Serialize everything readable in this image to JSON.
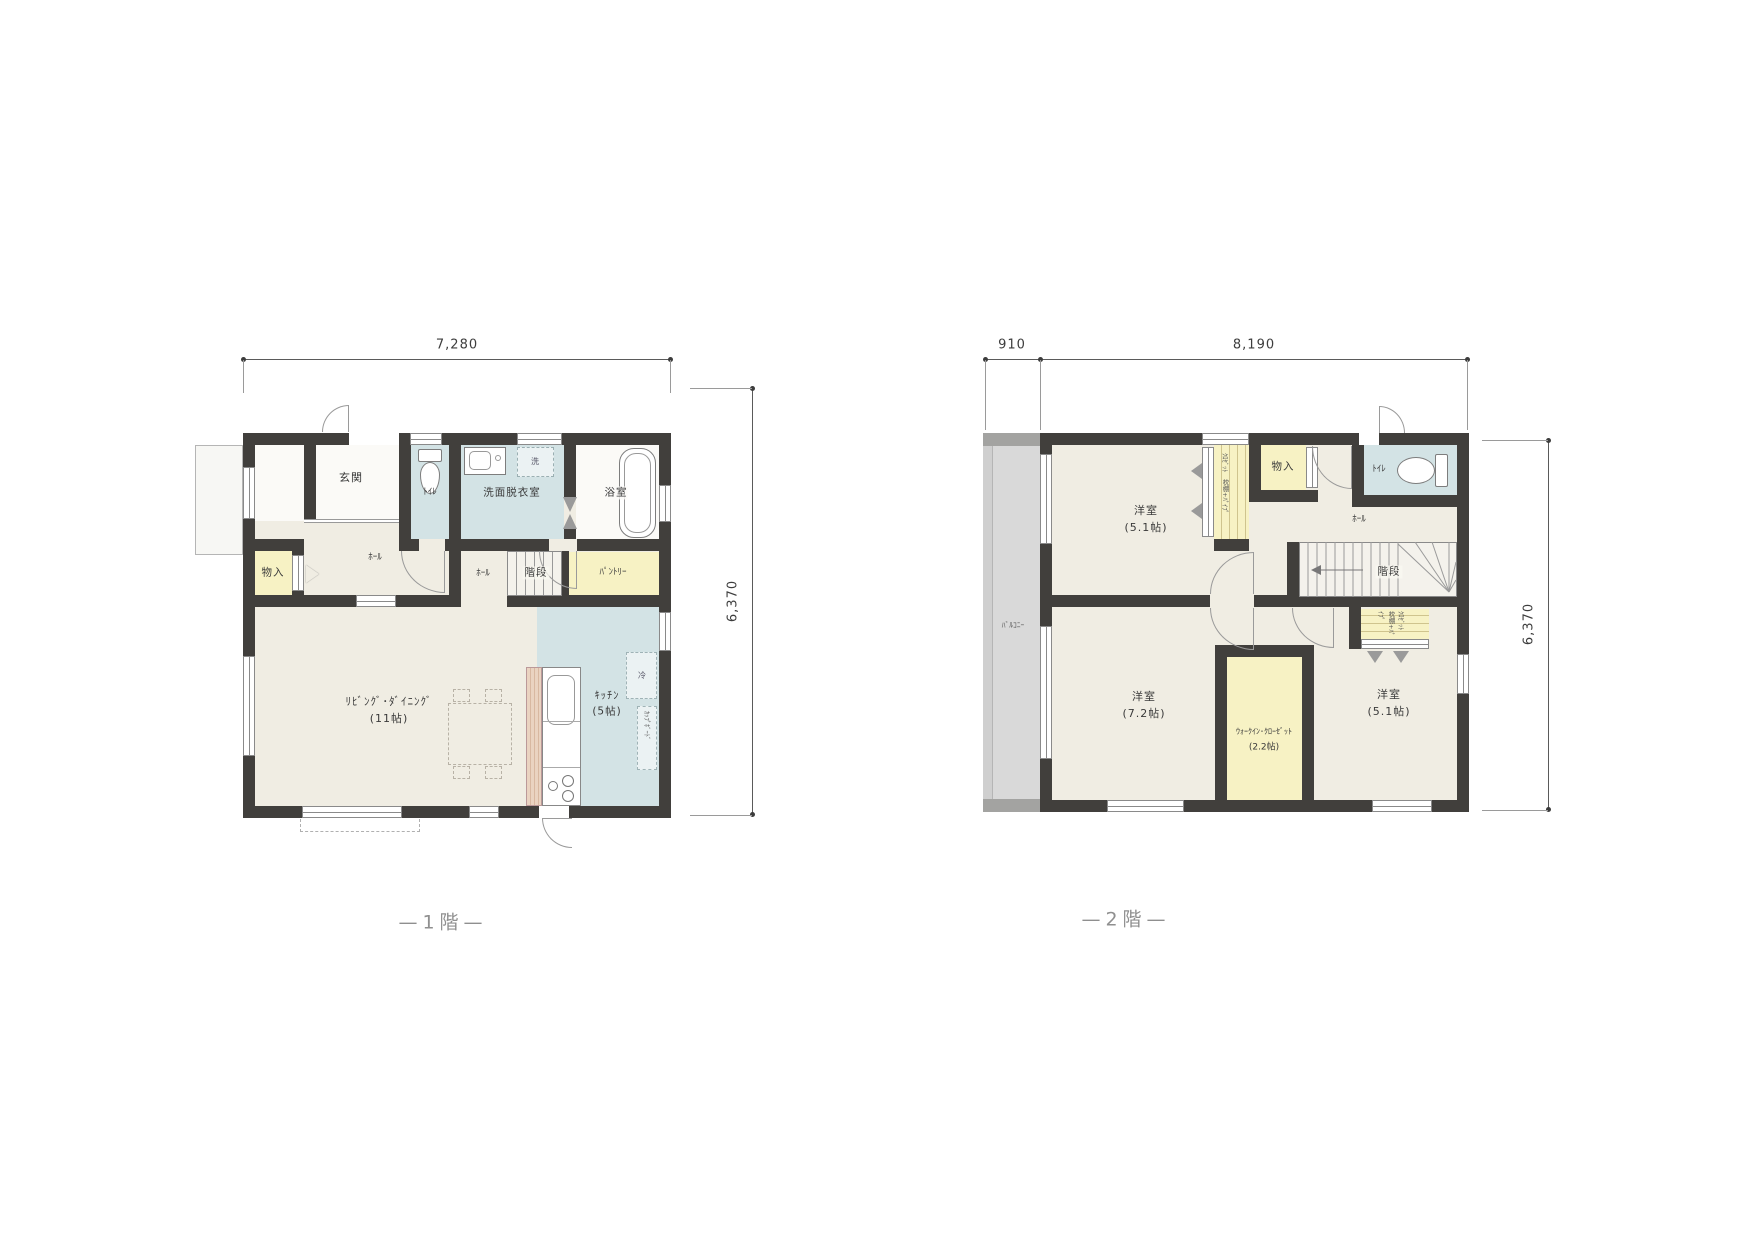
{
  "colors": {
    "wall": "#413f3c",
    "floor_beige": "#f0ede3",
    "wet_area_blue": "#d3e3e5",
    "storage_yellow": "#f7f2c4",
    "balcony_gray": "#d9d9d9",
    "dimension_text": "#3d3d3d",
    "floor_label_gray": "#8f8f8f"
  },
  "floor1": {
    "floor_label": "—1階—",
    "dim_top": "7,280",
    "dim_right": "6,370",
    "rooms": {
      "genkan": "玄関",
      "toilet": "ﾄｲﾚ",
      "washroom": "洗面脱衣室",
      "bath": "浴室",
      "washer": "洗",
      "storage": "物入",
      "hall_front": "ﾎｰﾙ",
      "hall_stair": "ﾎｰﾙ",
      "stairs": "階段",
      "pantry": "ﾊﾟﾝﾄﾘｰ",
      "living": "ﾘﾋﾞﾝｸﾞ･ﾀﾞｲﾆﾝｸﾞ",
      "living_size": "(11帖)",
      "kitchen": "ｷｯﾁﾝ",
      "kitchen_size": "(5帖)",
      "fridge": "冷",
      "cupboard": "ｶｯﾌﾟﾎﾞｰﾄﾞ"
    }
  },
  "floor2": {
    "floor_label": "—2階—",
    "dim_balcony": "910",
    "dim_top": "8,190",
    "dim_right": "6,370",
    "rooms": {
      "balcony": "ﾊﾞﾙｺﾆｰ",
      "bedroom_a": "洋室",
      "bedroom_a_size": "(5.1帖)",
      "closet_a_line1": "ｸﾛｾﾞｯﾄ",
      "closet_a_line2": "枕棚+ﾊﾟｲﾌﾟ",
      "storage": "物入",
      "toilet": "ﾄｲﾚ",
      "hall": "ﾎｰﾙ",
      "stairs": "階段",
      "bedroom_b": "洋室",
      "bedroom_b_size": "(7.2帖)",
      "wic": "ｳｫｰｸｲﾝ･ｸﾛｰｾﾞｯﾄ",
      "wic_size": "(2.2帖)",
      "closet_b_line1": "ｸﾛｾﾞｯﾄ",
      "closet_b_line2": "枕棚+ﾊﾟｲﾌﾟ",
      "bedroom_c": "洋室",
      "bedroom_c_size": "(5.1帖)"
    }
  }
}
